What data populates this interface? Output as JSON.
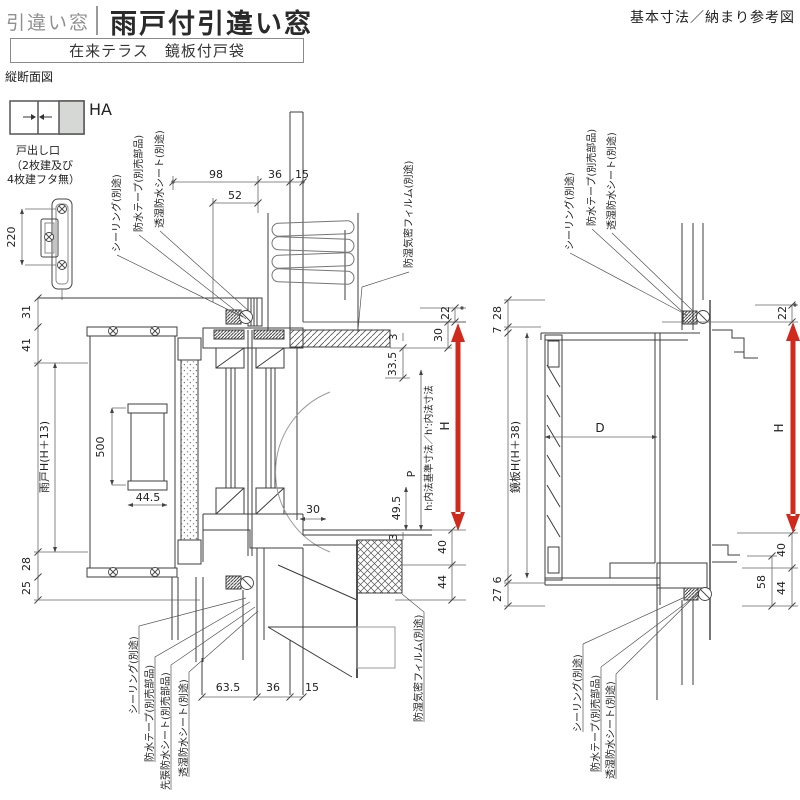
{
  "header": {
    "category": "引違い窓",
    "title": "雨戸付引違い窓",
    "variant": "在来テラス　鏡板付戸袋",
    "reference": "基本寸法／納まり参考図",
    "view_label": "縦断面図"
  },
  "legend": {
    "code": "HA",
    "caption": [
      "戸出し口",
      "（2枚建及び",
      "4枚建フタ無）"
    ],
    "pull_pitch": "220"
  },
  "left_view": {
    "callouts_top": [
      "シーリング(別途)",
      "防水テープ(別売部品)",
      "透湿防水シート(別途)",
      "防湿気密フィルム(別途)"
    ],
    "callouts_bottom": [
      "シーリング(別途)",
      "防水テープ(別売部品)",
      "先張防水シート(別売部品)",
      "透湿防水シート(別途)",
      "防湿気密フィルム(別途)"
    ],
    "dims_top": [
      "98",
      "52",
      "36",
      "15"
    ],
    "dims_left": [
      "31",
      "41",
      "雨戸H(H＋13)",
      "28",
      "25"
    ],
    "dims_inner": [
      "500",
      "44.5",
      "30",
      "49.5",
      "P",
      "3"
    ],
    "dims_head": [
      "3",
      "33.5"
    ],
    "dims_right": [
      "22",
      "30",
      "40",
      "44"
    ],
    "dims_bottom": [
      "63.5",
      "36",
      "15"
    ],
    "height_arrow": "H",
    "note": "h:内法基準寸法／h':内法寸法"
  },
  "right_view": {
    "callouts_top": [
      "シーリング(別途)",
      "防水テープ(別売部品)",
      "透湿防水シート(別途)"
    ],
    "callouts_bottom": [
      "シーリング(別途)",
      "防水テープ(別売部品)",
      "透湿防水シート(別途)"
    ],
    "dims_left": [
      "28",
      "7",
      "鏡板H(H＋38)",
      "6",
      "27"
    ],
    "dims_right": [
      "22",
      "40",
      "58",
      "44"
    ],
    "depth": "D",
    "height_arrow": "H"
  },
  "colors": {
    "accent": "#d02a1d",
    "line": "#3d3d3d",
    "panel_gray": "#d6d8d5"
  }
}
